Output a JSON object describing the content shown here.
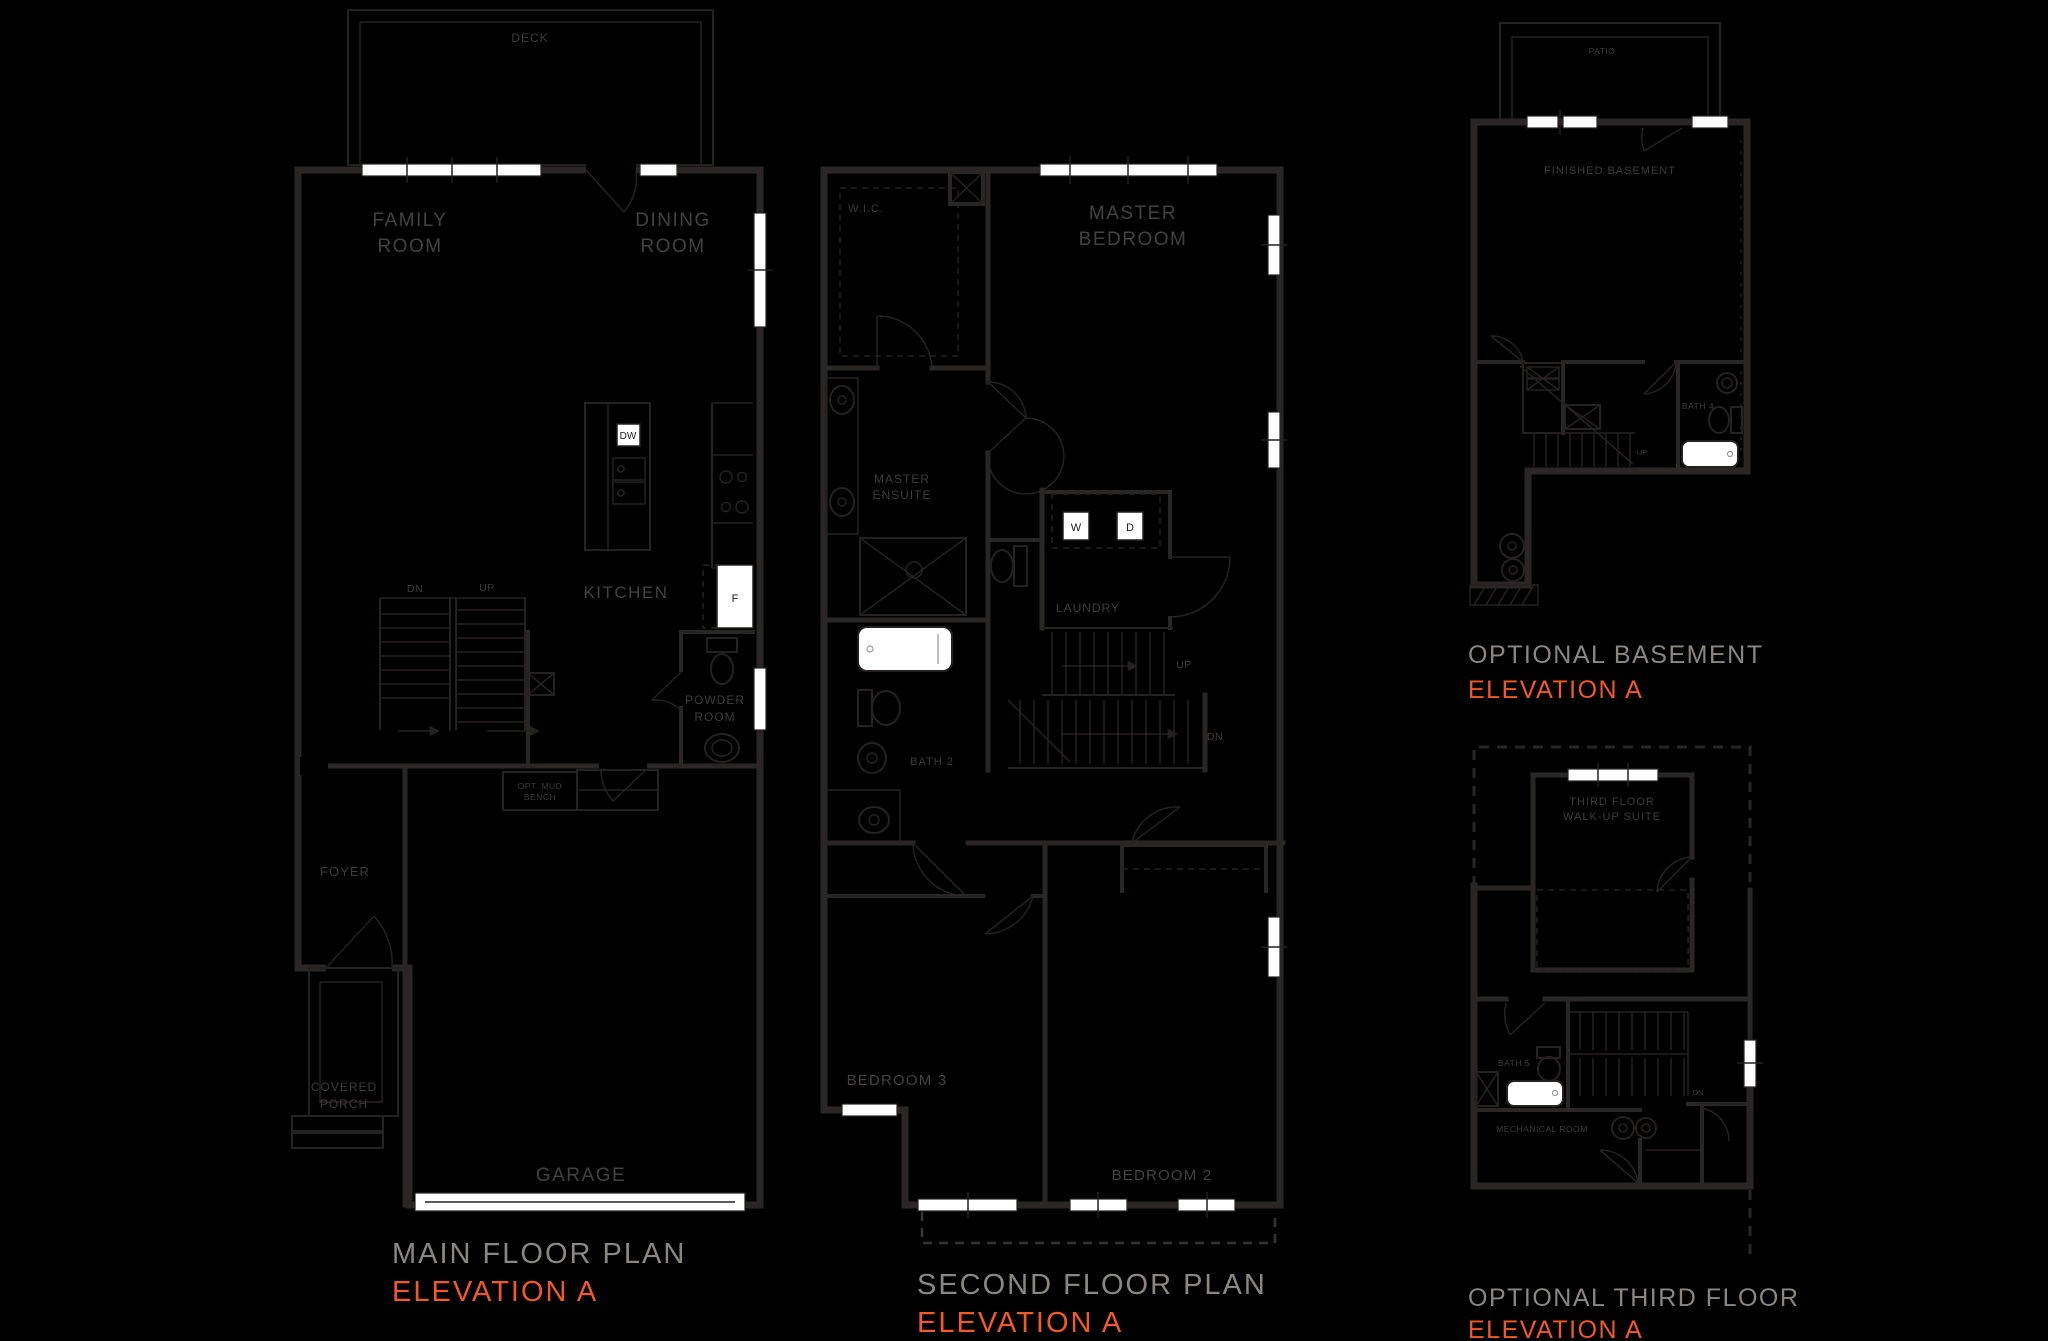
{
  "colors": {
    "background": "#000000",
    "wall": "#2b2626",
    "line": "#262121",
    "label": "#454141",
    "label_small": "#3e3a3a",
    "title_gray": "#8b8680",
    "accent_orange": "#f15a25",
    "white": "#ffffff",
    "appliance_text": "#1e1b1b"
  },
  "main_floor": {
    "title": "MAIN FLOOR PLAN",
    "subtitle": "ELEVATION A",
    "rooms": {
      "deck": "DECK",
      "family_room": [
        "FAMILY",
        "ROOM"
      ],
      "dining_room": [
        "DINING",
        "ROOM"
      ],
      "kitchen": "KITCHEN",
      "powder_room": [
        "POWDER",
        "ROOM"
      ],
      "mud_bench": [
        "OPT. MUD",
        "BENCH"
      ],
      "foyer": "FOYER",
      "covered_porch": [
        "COVERED",
        "PORCH"
      ],
      "garage": "GARAGE"
    },
    "appliances": {
      "dishwasher": "DW",
      "fridge": "F"
    },
    "stairs": {
      "down": "DN",
      "up": "UP"
    }
  },
  "second_floor": {
    "title": "SECOND FLOOR PLAN",
    "subtitle": "ELEVATION A",
    "rooms": {
      "wic": "W.I.C.",
      "master_bedroom": [
        "MASTER",
        "BEDROOM"
      ],
      "master_ensuite": [
        "MASTER",
        "ENSUITE"
      ],
      "laundry": "LAUNDRY",
      "bath_2": "BATH 2",
      "bedroom_3": "BEDROOM 3",
      "bedroom_2": "BEDROOM 2"
    },
    "appliances": {
      "washer": "W",
      "dryer": "D"
    },
    "stairs": {
      "up": "UP",
      "down": "DN"
    }
  },
  "basement": {
    "title": "OPTIONAL BASEMENT",
    "subtitle": "ELEVATION A",
    "rooms": {
      "patio": "PATIO",
      "finished_basement": "FINISHED BASEMENT",
      "bath_4": "BATH 4"
    },
    "stairs": {
      "up": "UP"
    }
  },
  "third_floor": {
    "title": "OPTIONAL THIRD FLOOR",
    "subtitle": "ELEVATION A",
    "rooms": {
      "suite": [
        "THIRD FLOOR",
        "WALK-UP SUITE"
      ],
      "bath_5": "BATH 5",
      "mechanical": "MECHANICAL ROOM"
    },
    "stairs": {
      "down": "DN"
    }
  }
}
